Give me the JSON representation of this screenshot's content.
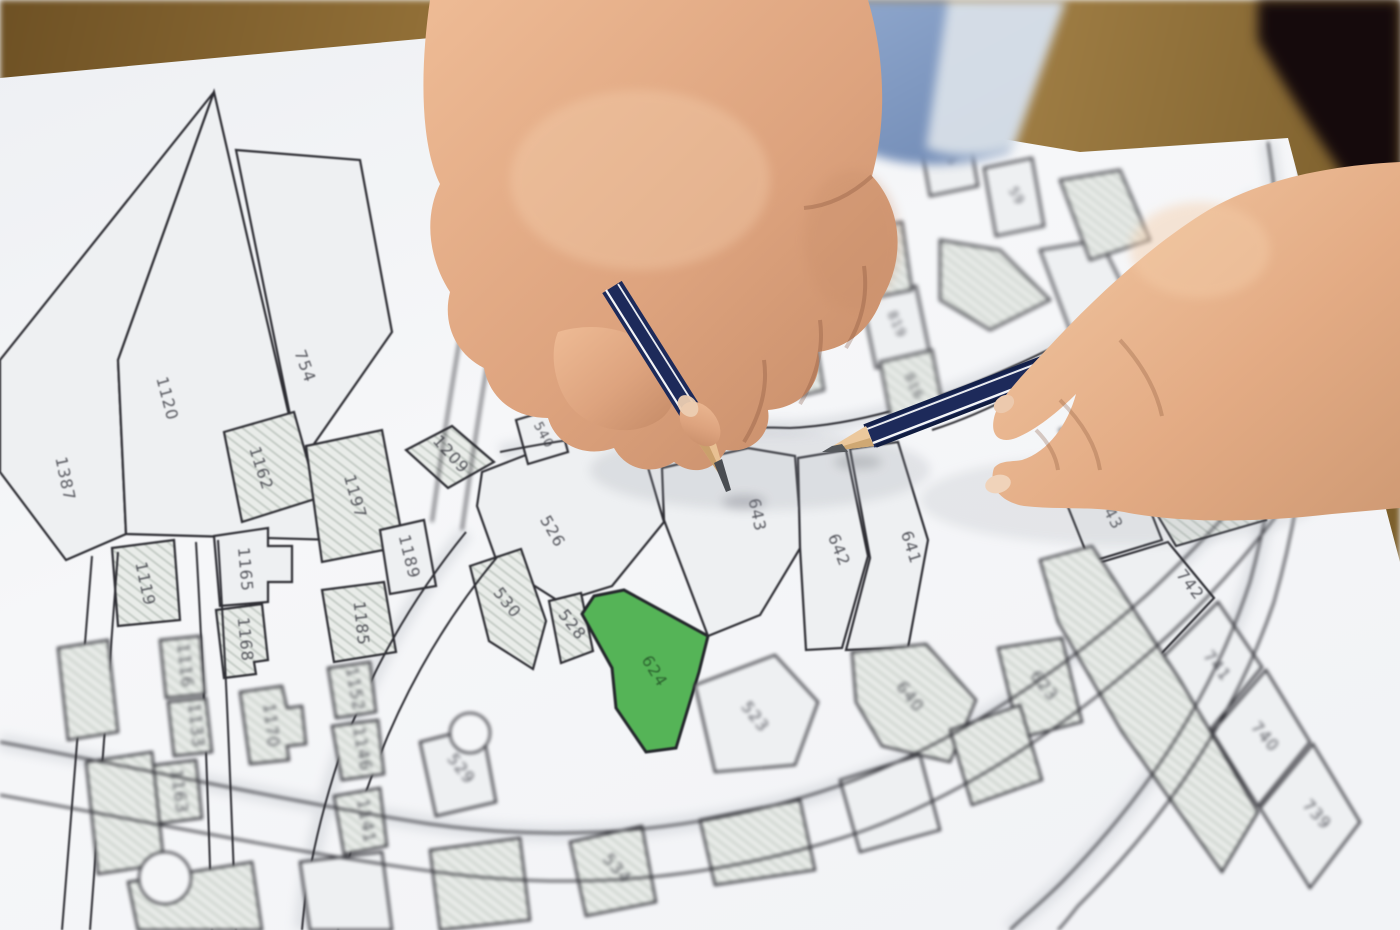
{
  "map": {
    "highlighted_parcel": "624",
    "colors": {
      "highlight_green": "#55b457",
      "paper": "#f5f6f8",
      "boundary_line": "#2d2d33",
      "hatch_fill": "#e9ece9",
      "wood_table": "#8f6f36",
      "pencil_navy": "#1d2a5a",
      "sleeve_blue": "#8aa2c8"
    },
    "parcels": [
      {
        "label": "1387"
      },
      {
        "label": "1120"
      },
      {
        "label": "754"
      },
      {
        "label": "1162"
      },
      {
        "label": "1197"
      },
      {
        "label": "1209"
      },
      {
        "label": "1189"
      },
      {
        "label": "1165"
      },
      {
        "label": "1119"
      },
      {
        "label": "1168"
      },
      {
        "label": "1185"
      },
      {
        "label": "526"
      },
      {
        "label": "530"
      },
      {
        "label": "528"
      },
      {
        "label": "624",
        "highlighted": true
      },
      {
        "label": "643"
      },
      {
        "label": "642"
      },
      {
        "label": "641"
      },
      {
        "label": "540"
      },
      {
        "label": "743"
      },
      {
        "label": "1039"
      },
      {
        "label": "742"
      },
      {
        "label": "811"
      },
      {
        "label": "816"
      },
      {
        "label": "819"
      },
      {
        "label": "56"
      },
      {
        "label": "59"
      },
      {
        "label": "58"
      },
      {
        "label": "1116"
      },
      {
        "label": "1133"
      },
      {
        "label": "1170"
      },
      {
        "label": "1152"
      },
      {
        "label": "1146"
      },
      {
        "label": "1163"
      },
      {
        "label": "1141"
      },
      {
        "label": "640"
      },
      {
        "label": "623"
      },
      {
        "label": "523"
      },
      {
        "label": "529"
      },
      {
        "label": "534"
      },
      {
        "label": "741"
      },
      {
        "label": "740"
      },
      {
        "label": "739"
      }
    ]
  }
}
